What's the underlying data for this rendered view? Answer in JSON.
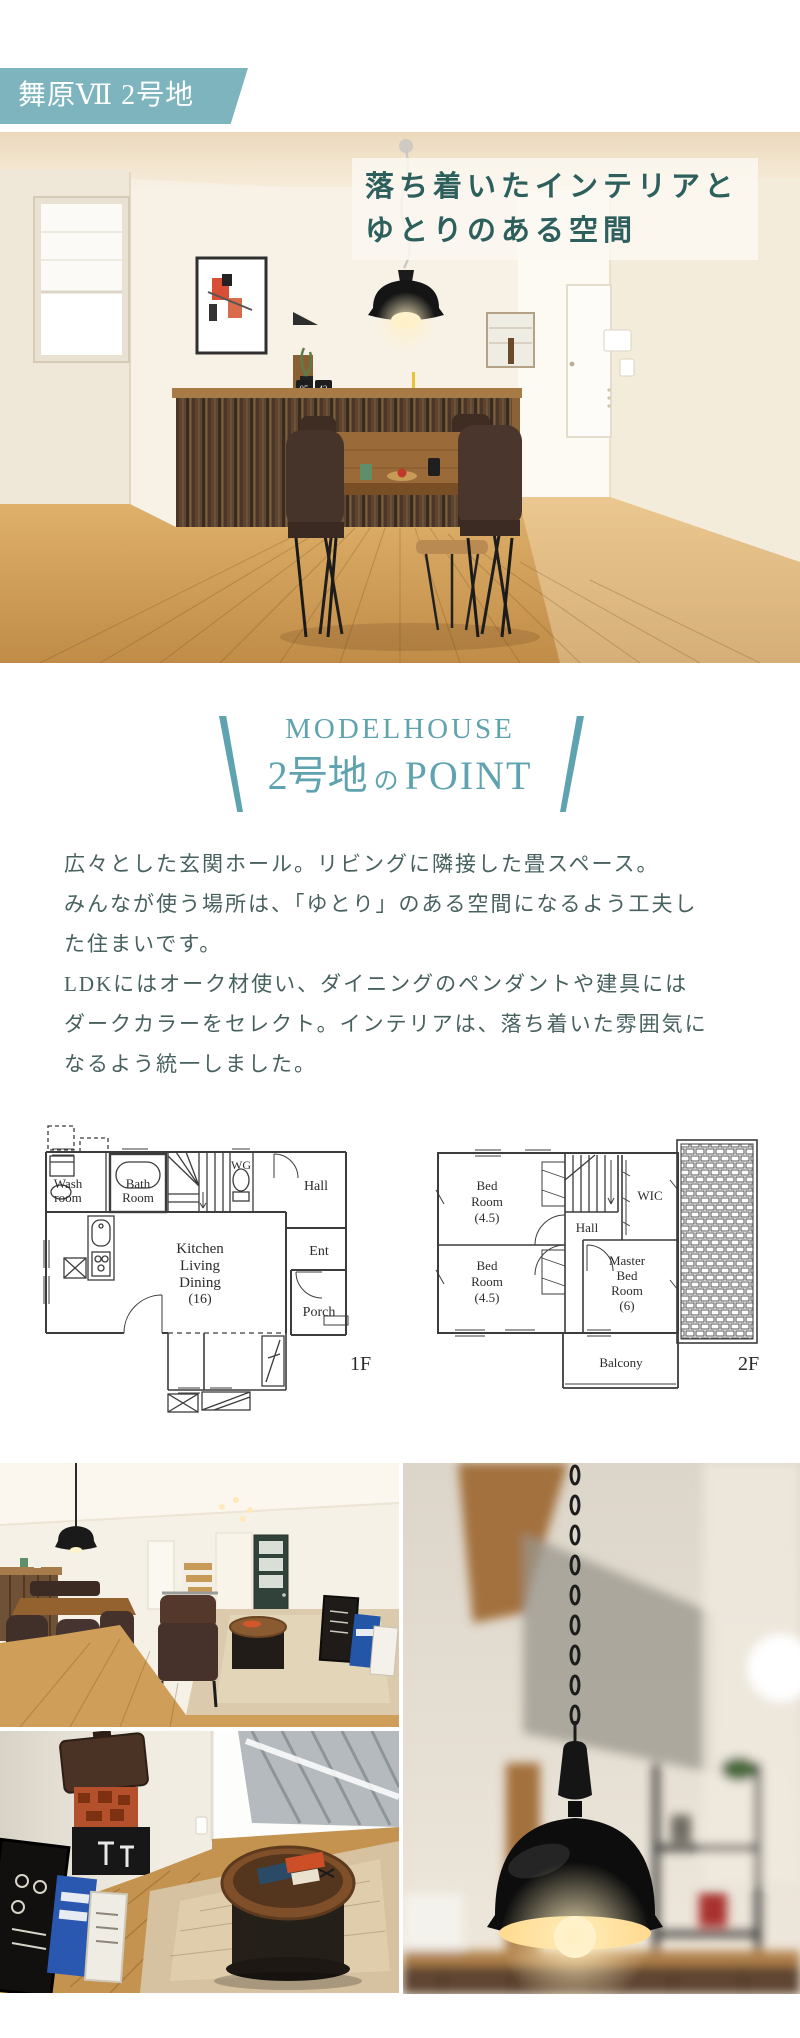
{
  "theme": {
    "accent": "#7db4bd",
    "heading": "#5fa3b0",
    "title": "#2d5f5d",
    "body": "#47615f",
    "plan-line": "#3c3c3c"
  },
  "badge": {
    "label": "舞原Ⅶ 2号地"
  },
  "hero": {
    "title_lines": [
      "落ち着いたインテリアと",
      "ゆとりのある空間"
    ],
    "clock_hh": "05",
    "clock_mm": "42"
  },
  "point": {
    "eyebrow": "MODELHOUSE",
    "lot": "2号地",
    "particle": "の",
    "word": "POINT"
  },
  "description": {
    "lines": [
      "広々とした玄関ホール。リビングに隣接した畳スペース。",
      "みんなが使う場所は、「ゆとり」のある空間になるよう工夫し",
      "た住まいです。",
      "LDKにはオーク材使い、ダイニングのペンダントや建具には",
      "ダークカラーをセレクト。インテリアは、落ち着いた雰囲気に",
      "なるよう統一しました。"
    ]
  },
  "floorplan_1f": {
    "tag": "1F",
    "wash_l1": "Wash",
    "wash_l2": "room",
    "bath_l1": "Bath",
    "bath_l2": "Room",
    "wg": "WG",
    "hall": "Hall",
    "ldk_l1": "Kitchen",
    "ldk_l2": "Living",
    "ldk_l3": "Dining",
    "ldk_l4": "(16)",
    "ent": "Ent",
    "porch": "Porch"
  },
  "floorplan_2f": {
    "tag": "2F",
    "bed1_l1": "Bed",
    "bed1_l2": "Room",
    "bed1_l3": "(4.5)",
    "bed2_l1": "Bed",
    "bed2_l2": "Room",
    "bed2_l3": "(4.5)",
    "hall": "Hall",
    "wic": "WIC",
    "master_l1": "Master",
    "master_l2": "Bed",
    "master_l3": "Room",
    "master_l4": "(6)",
    "balcony": "Balcony"
  }
}
